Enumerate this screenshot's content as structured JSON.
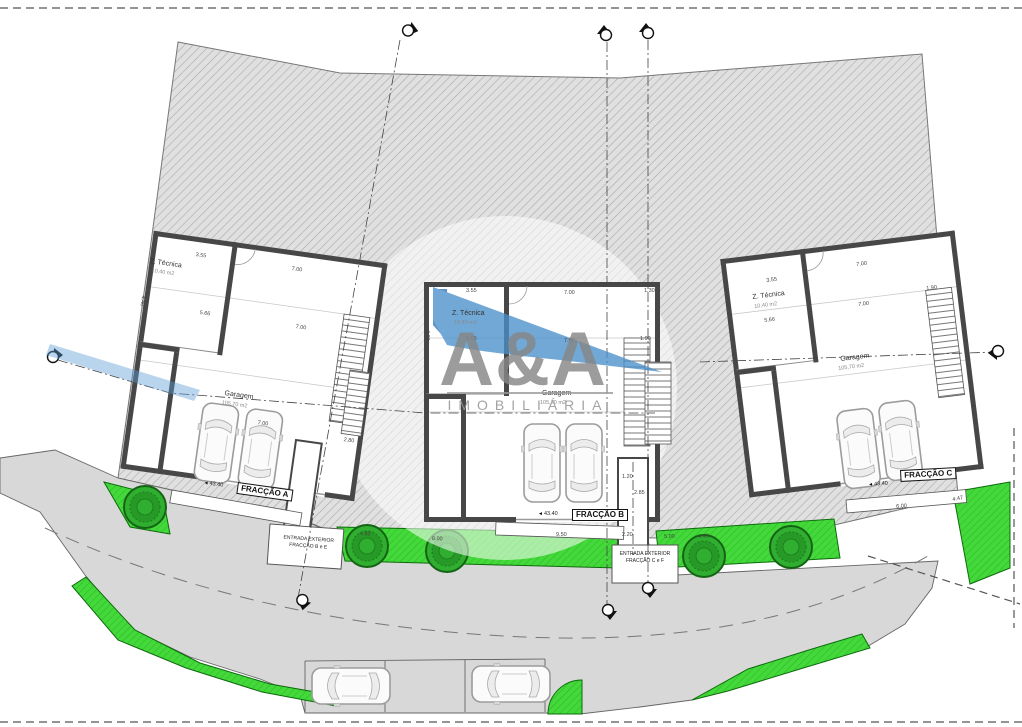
{
  "watermark": {
    "logo": "A&A",
    "subtitle": "IMOBILIÁRIA"
  },
  "icons": {
    "elevation_arrow": "◄"
  },
  "units": [
    {
      "fraction": "FRACÇÃO A",
      "tech_room": "Z. Técnica",
      "tech_area": "10,40 m2",
      "garage": "Garagem",
      "garage_area": "105,70 m2",
      "elevation": "43.40"
    },
    {
      "fraction": "FRACÇÃO B",
      "tech_room": "Z. Técnica",
      "tech_area": "10,40 m2",
      "garage": "Garagem",
      "garage_area": "105,70 m2",
      "elevation": "43.40"
    },
    {
      "fraction": "FRACÇÃO C",
      "tech_room": "Z. Técnica",
      "tech_area": "10,40 m2",
      "garage": "Garagem",
      "garage_area": "105,70 m2",
      "elevation": "43.40"
    }
  ],
  "entrances": [
    {
      "line1": "ENTRADA EXTERIOR",
      "line2": "FRACÇÃO B e E"
    },
    {
      "line1": "ENTRADA EXTERIOR",
      "line2": "FRACÇÃO C e F"
    }
  ],
  "dimensions": [
    {
      "t": "3.55",
      "x": 196,
      "y": 252,
      "r": 8
    },
    {
      "t": "7.00",
      "x": 292,
      "y": 266,
      "r": 8
    },
    {
      "t": "4.40",
      "x": 146,
      "y": 296,
      "r": 98
    },
    {
      "t": "5.66",
      "x": 200,
      "y": 310,
      "r": 8
    },
    {
      "t": "7.00",
      "x": 296,
      "y": 324,
      "r": 8
    },
    {
      "t": "7.00",
      "x": 258,
      "y": 420,
      "r": 8
    },
    {
      "t": "2.80",
      "x": 344,
      "y": 437,
      "r": 8
    },
    {
      "t": "3.55",
      "x": 466,
      "y": 288,
      "r": 0
    },
    {
      "t": "7.00",
      "x": 564,
      "y": 290,
      "r": 0
    },
    {
      "t": "1.30",
      "x": 644,
      "y": 288,
      "r": 0
    },
    {
      "t": "4.00",
      "x": 430,
      "y": 330,
      "r": 90
    },
    {
      "t": "5.66",
      "x": 466,
      "y": 336,
      "r": 0
    },
    {
      "t": "7.00",
      "x": 564,
      "y": 338,
      "r": 0
    },
    {
      "t": "1.90",
      "x": 640,
      "y": 336,
      "r": 0
    },
    {
      "t": "1.20",
      "x": 622,
      "y": 474,
      "r": 0
    },
    {
      "t": "2.85",
      "x": 634,
      "y": 490,
      "r": 0
    },
    {
      "t": "9.50",
      "x": 556,
      "y": 532,
      "r": 0
    },
    {
      "t": "2.20",
      "x": 622,
      "y": 532,
      "r": 0
    },
    {
      "t": "5.00",
      "x": 664,
      "y": 534,
      "r": -2
    },
    {
      "t": "3.55",
      "x": 766,
      "y": 278,
      "r": -7
    },
    {
      "t": "7.00",
      "x": 856,
      "y": 262,
      "r": -7
    },
    {
      "t": "5.66",
      "x": 764,
      "y": 318,
      "r": -7
    },
    {
      "t": "7.00",
      "x": 858,
      "y": 302,
      "r": -7
    },
    {
      "t": "1.90",
      "x": 926,
      "y": 286,
      "r": -7
    },
    {
      "t": "6.00",
      "x": 896,
      "y": 504,
      "r": -4
    },
    {
      "t": "4.47",
      "x": 952,
      "y": 497,
      "r": -10
    },
    {
      "t": "4.93",
      "x": 360,
      "y": 531,
      "r": 3
    },
    {
      "t": "4.45",
      "x": 698,
      "y": 534,
      "r": -3
    },
    {
      "t": "8.00",
      "x": 432,
      "y": 536,
      "r": 2
    }
  ],
  "colors": {
    "roof_blue": "#4a90c9",
    "green": "#44d93a",
    "wall": "#474747",
    "road": "#d8d8d8"
  }
}
